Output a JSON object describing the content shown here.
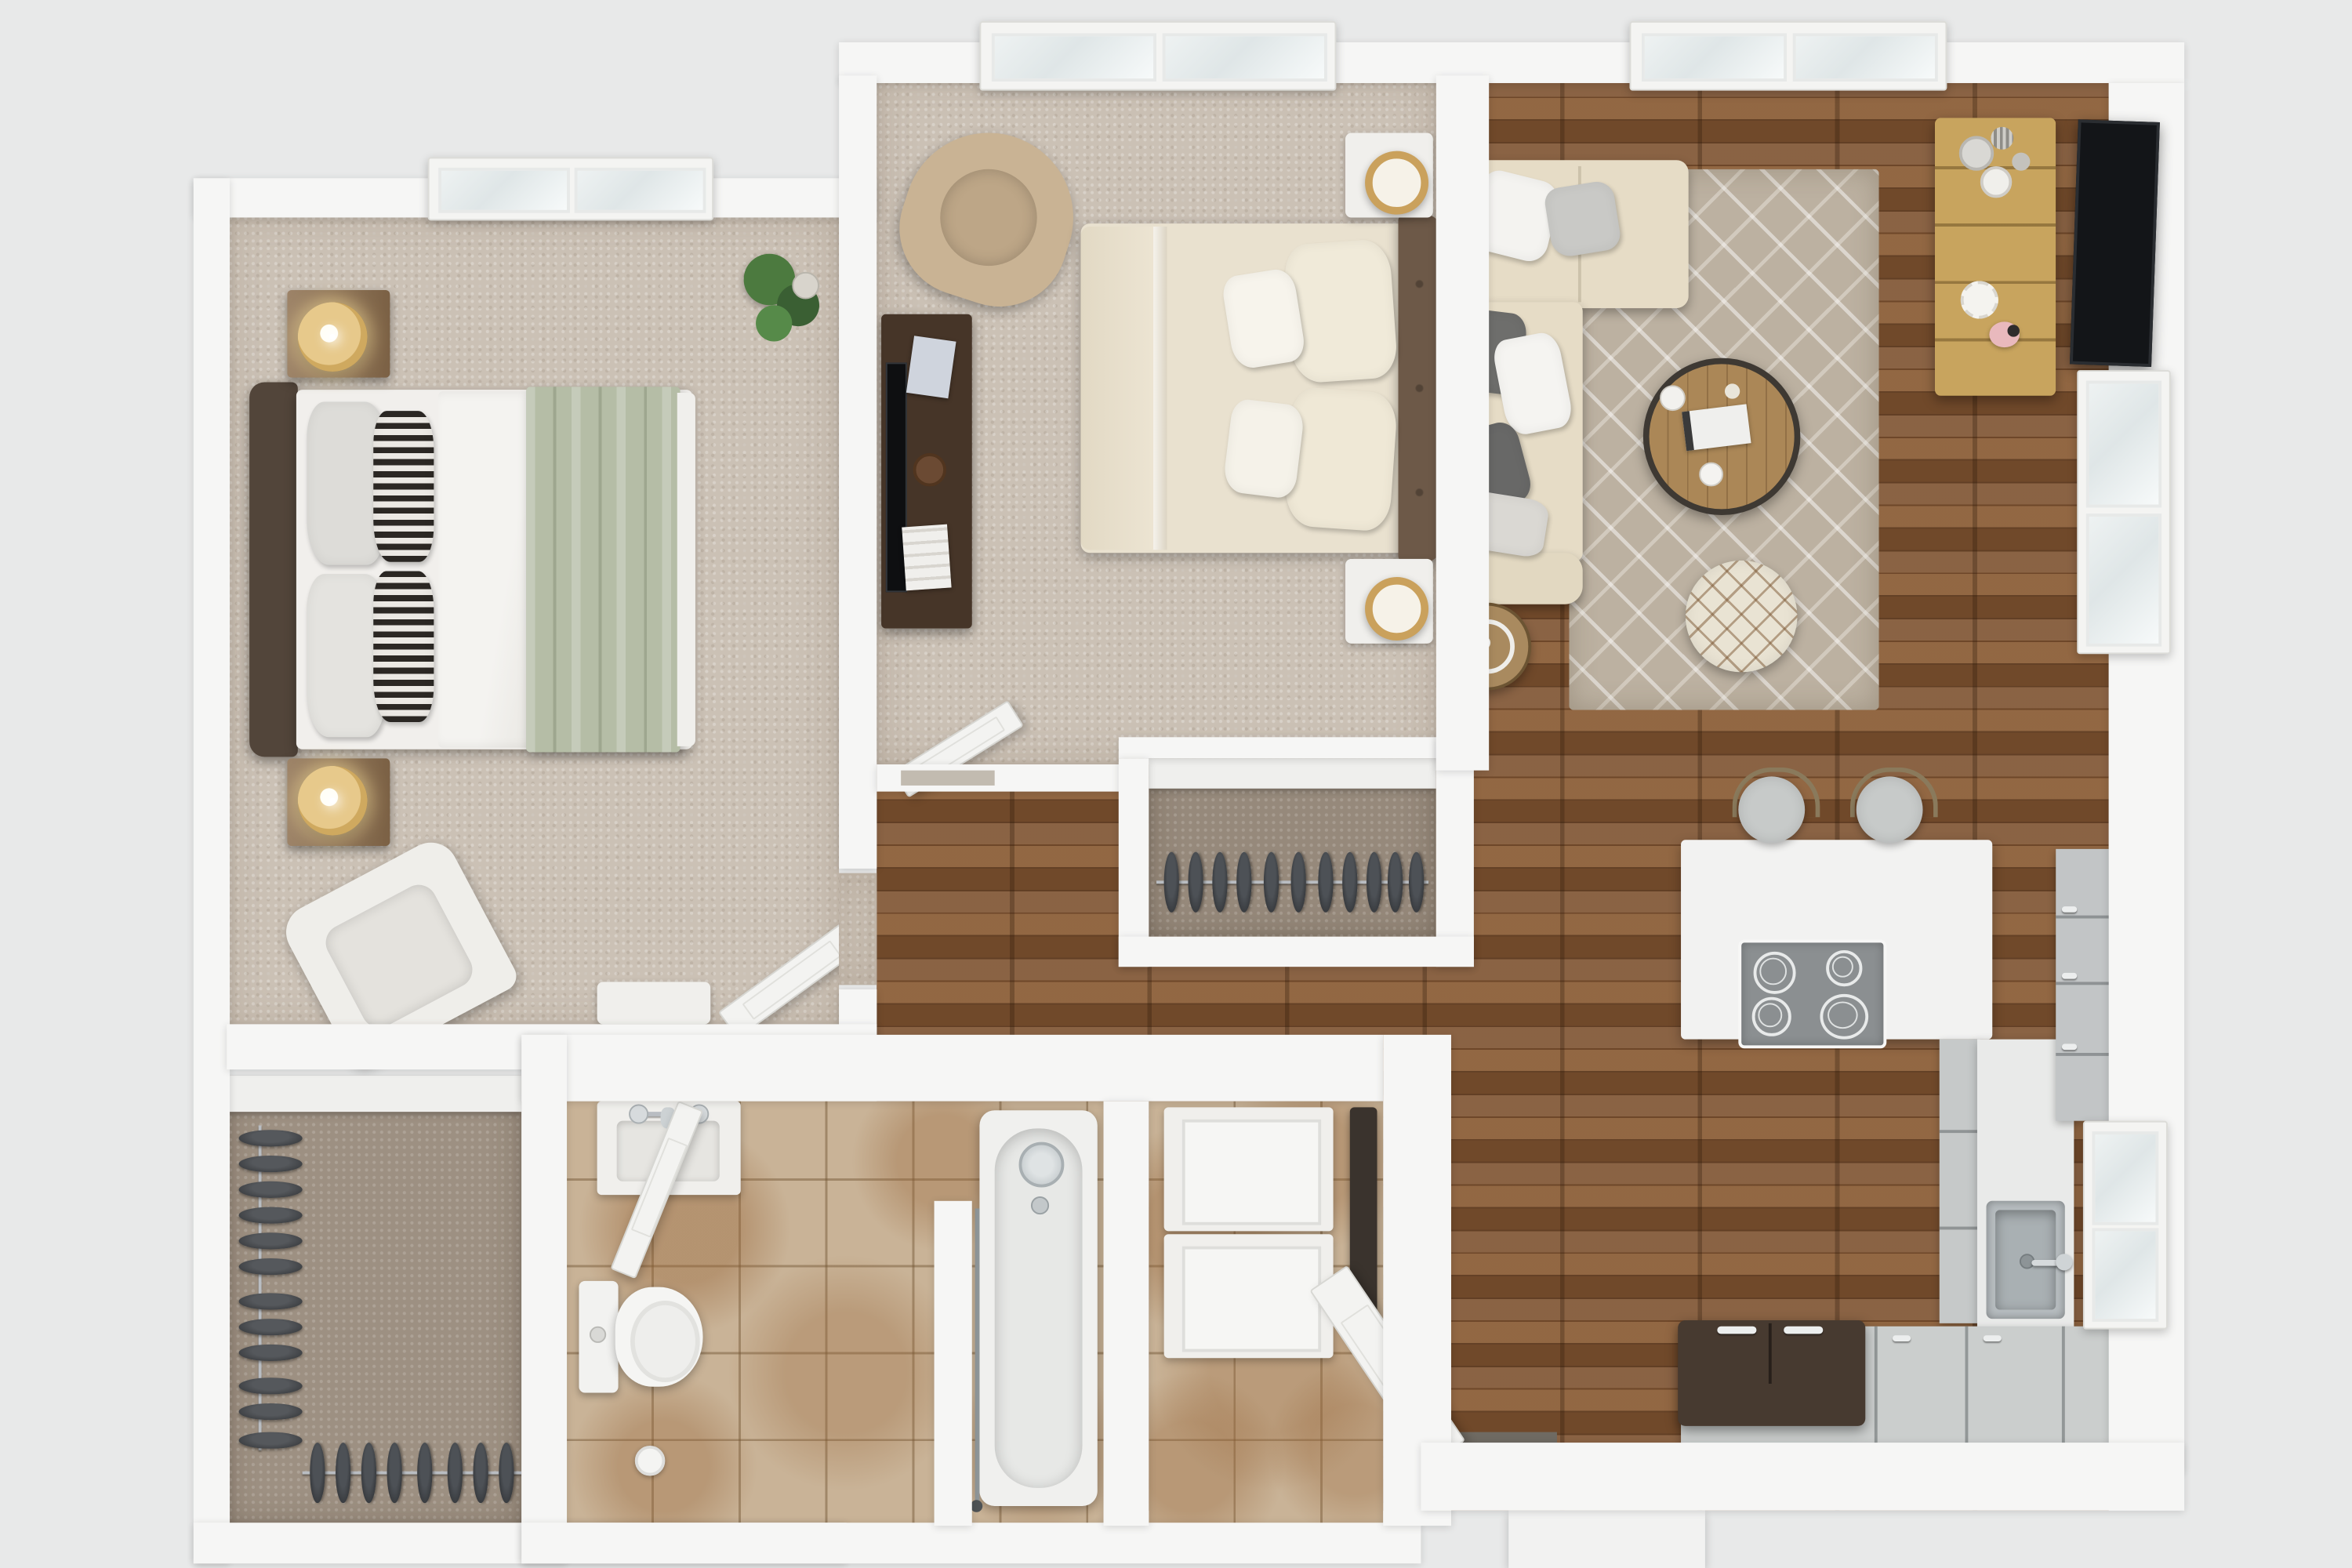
{
  "scene": {
    "type": "3d-floor-plan-top-view",
    "description": "Photorealistic top-down 3D rendering of a one-story two-bedroom apartment floor plan. No text labels are rendered in the image.",
    "rooms": [
      {
        "name": "bedroom-primary",
        "floor": "beige-carpet",
        "furniture": [
          "upholstered-bed-green-throw",
          "striped-accent-pillows",
          "wood-nightstand",
          "wood-nightstand",
          "gold-table-lamp",
          "gold-table-lamp",
          "potted-plant",
          "white-armchair",
          "white-console-shelf",
          "skylight-window",
          "interior-door-open"
        ]
      },
      {
        "name": "bedroom-secondary",
        "floor": "beige-carpet",
        "furniture": [
          "cream-bed-tufted-headboard",
          "white-nightstand",
          "white-nightstand",
          "gold-ring-lamp",
          "gold-ring-lamp",
          "dark-wood-media-desk",
          "flatscreen-tv-on-desk",
          "tan-wingback-chair",
          "skylight-window",
          "interior-door-open",
          "reach-in-closet-hanging-clothes"
        ]
      },
      {
        "name": "living-room",
        "floor": "hardwood",
        "furniture": [
          "cream-sectional-sofa",
          "grey-and-white-throw-pillows",
          "geometric-area-rug",
          "round-wood-coffee-table",
          "round-pouf-ottoman",
          "round-side-table",
          "oak-media-console",
          "decor-vases",
          "wall-mounted-tv",
          "double-hung-windows",
          "skylight-window"
        ]
      },
      {
        "name": "kitchen",
        "floor": "hardwood",
        "furniture": [
          "white-peninsula-counter",
          "four-burner-cooktop",
          "bar-stool",
          "bar-stool",
          "grey-base-cabinets",
          "grey-tall-cabinets",
          "stainless-sink-with-faucet",
          "french-door-refrigerator",
          "window"
        ]
      },
      {
        "name": "bathroom",
        "floor": "beige-marble-tile",
        "furniture": [
          "white-vanity-sink",
          "toilet",
          "toilet-paper-holder",
          "bathtub-with-shower",
          "glass-partition",
          "interior-door-open"
        ]
      },
      {
        "name": "laundry-closet",
        "floor": "beige-marble-tile",
        "furniture": [
          "washer",
          "dryer",
          "water-heater"
        ]
      },
      {
        "name": "walk-in-closet",
        "floor": "taupe-carpet",
        "furniture": [
          "hanging-rod-side",
          "hanging-rod-bottom",
          "dark-garments",
          "shelf"
        ]
      },
      {
        "name": "hallway",
        "floor": "hardwood",
        "furniture": []
      },
      {
        "name": "entry",
        "floor": "hardwood",
        "furniture": [
          "front-door-open",
          "exterior-stoop"
        ]
      }
    ],
    "counts": {
      "skylights": 3,
      "exterior-windows": 3,
      "open-door-leafs": 5,
      "closet-garments-side-rod": 13,
      "closet-garments-bottom-rod": 8,
      "closet2-garments": 11,
      "bar-stools": 2
    }
  },
  "palette": {
    "background": "#e8e9e9",
    "wall": "#f6f6f5",
    "hardwood": "#7d512f",
    "carpet": "#cbc1b5",
    "closet_carpet": "#9d9082",
    "tile": "#c9b397",
    "rug": "#bcb1a1",
    "sofa": "#e6dcc6",
    "bed1_duvet": "#f1efec",
    "bed1_throw_green": "#b5bda6",
    "bed1_headboard": "#52453a",
    "bed2_duvet": "#e9e1cf",
    "bed2_headboard": "#6d5948",
    "nightstand_wood": "#8c6e4e",
    "lamp_gold": "#d8b877",
    "media_desk_dark": "#463528",
    "oak_console": "#c8a45e",
    "coffee_table": "#ab8757",
    "grey_cabinet": "#c6c9c9",
    "cooktop": "#8b8f91",
    "fridge": "#473a30",
    "sink_steel": "#b7bdc0",
    "tv_screen": "#131518",
    "wingback_tan": "#c9b394",
    "plant_green": "#4c7a3f"
  },
  "css": {
    "wood": "background-color:#7d512f",
    "carpet1": "background-color:#cbc1b5",
    "carpet2": "background-color:#cbc1b5",
    "closet1_floor": "background-color:#9d9082",
    "closet2_floor": "background-color:#96897b",
    "bath_tile": "background-color:#c9b397",
    "laundry_tile": "background-color:#c9b397",
    "rug": "background-color:#bcb1a1",
    "sofa_chaise": "background-color:#e6dcc6",
    "sofa_body": "background-color:#e6dcc6",
    "sofa_arm": "background-color:#e2d8c1",
    "bed1_duvet": "background-color:#f1efec",
    "bed1_throw": "background-color:#b5bda6",
    "bed1_headboard": "background-color:#52453a",
    "bed2_duvet": "background-color:#e9e1cf",
    "bed2_headboard": "background-color:#6d5948",
    "desk2": "background-color:#463528",
    "console_oak": "background-color:#c8a45e",
    "coffee_table": "background-color:#ab8757",
    "fridge": "background-color:#473a30",
    "cooktop": "background-color:#8b8f91",
    "wingback": "background-color:#c9b394"
  }
}
